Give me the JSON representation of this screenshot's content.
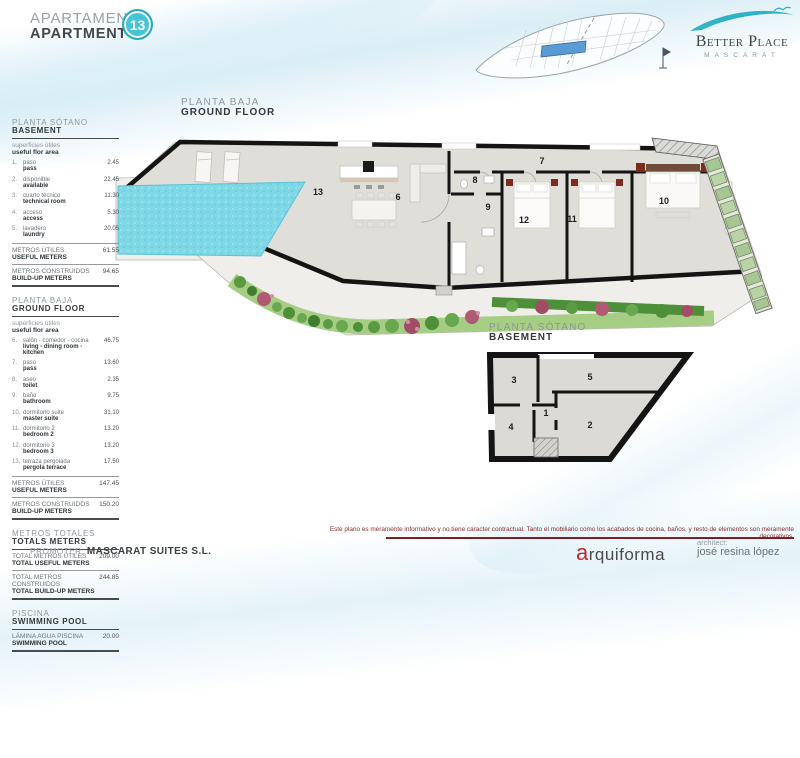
{
  "header": {
    "title_es": "APARTAMENTO",
    "title_en": "APARTMENT",
    "unit_number": "13"
  },
  "logo": {
    "brand": "Better Place",
    "sub": "MASCARAT"
  },
  "colors": {
    "accent_teal": "#47c4d3",
    "pool": "#7fd8e6",
    "disclaimer_red": "#8c2b2b",
    "hedge_green": "#4e8f3a"
  },
  "sidebar": {
    "basement": {
      "title_es": "PLANTA SÓTANO",
      "title_en": "BASEMENT",
      "subtitle_es": "superficies útiles",
      "subtitle_en": "useful flor area",
      "items": [
        {
          "num": "1.",
          "label_es": "paso",
          "label_en": "pass",
          "value": "2.45"
        },
        {
          "num": "2.",
          "label_es": "disponible",
          "label_en": "available",
          "value": "22.45"
        },
        {
          "num": "3.",
          "label_es": "cuarto técnico",
          "label_en": "technical room",
          "value": "11.30"
        },
        {
          "num": "4.",
          "label_es": "acceso",
          "label_en": "access",
          "value": "5.30"
        },
        {
          "num": "5.",
          "label_es": "lavadero",
          "label_en": "laundry",
          "value": "20.05"
        }
      ],
      "useful_es": "METROS ÚTILES",
      "useful_en": "USEFUL METERS",
      "useful_value": "61.55",
      "built_es": "METROS CONSTRUIDOS",
      "built_en": "BUILD-UP METERS",
      "built_value": "94.65"
    },
    "ground": {
      "title_es": "PLANTA BAJA",
      "title_en": "GROUND FLOOR",
      "subtitle_es": "superficies útiles",
      "subtitle_en": "useful flor area",
      "items": [
        {
          "num": "6.",
          "label_es": "salón - comedor - cocina",
          "label_en": "living - dining room - kitchen",
          "value": "46.75"
        },
        {
          "num": "7.",
          "label_es": "paso",
          "label_en": "pass",
          "value": "13.60"
        },
        {
          "num": "8.",
          "label_es": "aseo",
          "label_en": "toilet",
          "value": "2.35"
        },
        {
          "num": "9.",
          "label_es": "baño",
          "label_en": "bathroom",
          "value": "9.75"
        },
        {
          "num": "10.",
          "label_es": "dormitorio suite",
          "label_en": "master suite",
          "value": "31.10"
        },
        {
          "num": "11.",
          "label_es": "dormitorio 2",
          "label_en": "bedroom 2",
          "value": "13.20"
        },
        {
          "num": "12.",
          "label_es": "dormitorio 3",
          "label_en": "bedroom 3",
          "value": "13.20"
        },
        {
          "num": "13.",
          "label_es": "terraza pergolada",
          "label_en": "pergola terrace",
          "value": "17.50"
        }
      ],
      "useful_es": "METROS ÚTILES",
      "useful_en": "USEFUL METERS",
      "useful_value": "147.45",
      "built_es": "METROS CONSTRUIDOS",
      "built_en": "BUILD-UP METERS",
      "built_value": "150.20"
    },
    "totals": {
      "title_es": "METROS TOTALES",
      "title_en": "TOTALS METERS",
      "rows": [
        {
          "label_es": "TOTAL METROS ÚTILES",
          "label_en": "TOTAL USEFUL METERS",
          "value": "209.00"
        },
        {
          "label_es": "TOTAL METROS CONSTRUIDOS",
          "label_en": "TOTAL BUILD-UP METERS",
          "value": "244.85"
        }
      ]
    },
    "pool": {
      "title_es": "PISCINA",
      "title_en": "SWIMMING POOL",
      "label_es": "LÁMINA AGUA PISCINA",
      "label_en": "SWIMMING POOL",
      "value": "20.00"
    }
  },
  "plans": {
    "ground": {
      "title_es": "PLANTA BAJA",
      "title_en": "GROUND FLOOR",
      "rooms": {
        "pergola": "13",
        "living": "6",
        "hall": "7",
        "toilet": "8",
        "bath": "9",
        "bedroom3": "12",
        "bedroom2": "11",
        "master": "10"
      }
    },
    "basement": {
      "title_es": "PLANTA SÓTANO",
      "title_en": "BASEMENT",
      "rooms": {
        "pass": "1",
        "available": "2",
        "technical": "3",
        "access": "4",
        "laundry": "5"
      }
    }
  },
  "footer": {
    "disclaimer": "Este plano es meramente informativo y no tiene caracter contractual. Tanto el mobiliario como los acabados de cocina, baños, y resto de elementos son meramente decorativos.",
    "promoter_label": "PROMOTER:",
    "promoter_name": "MASCARAT SUITES S.L.",
    "studio": "arquiforma",
    "architect_label": "architect:",
    "architect_name": "josé resina lópez"
  }
}
